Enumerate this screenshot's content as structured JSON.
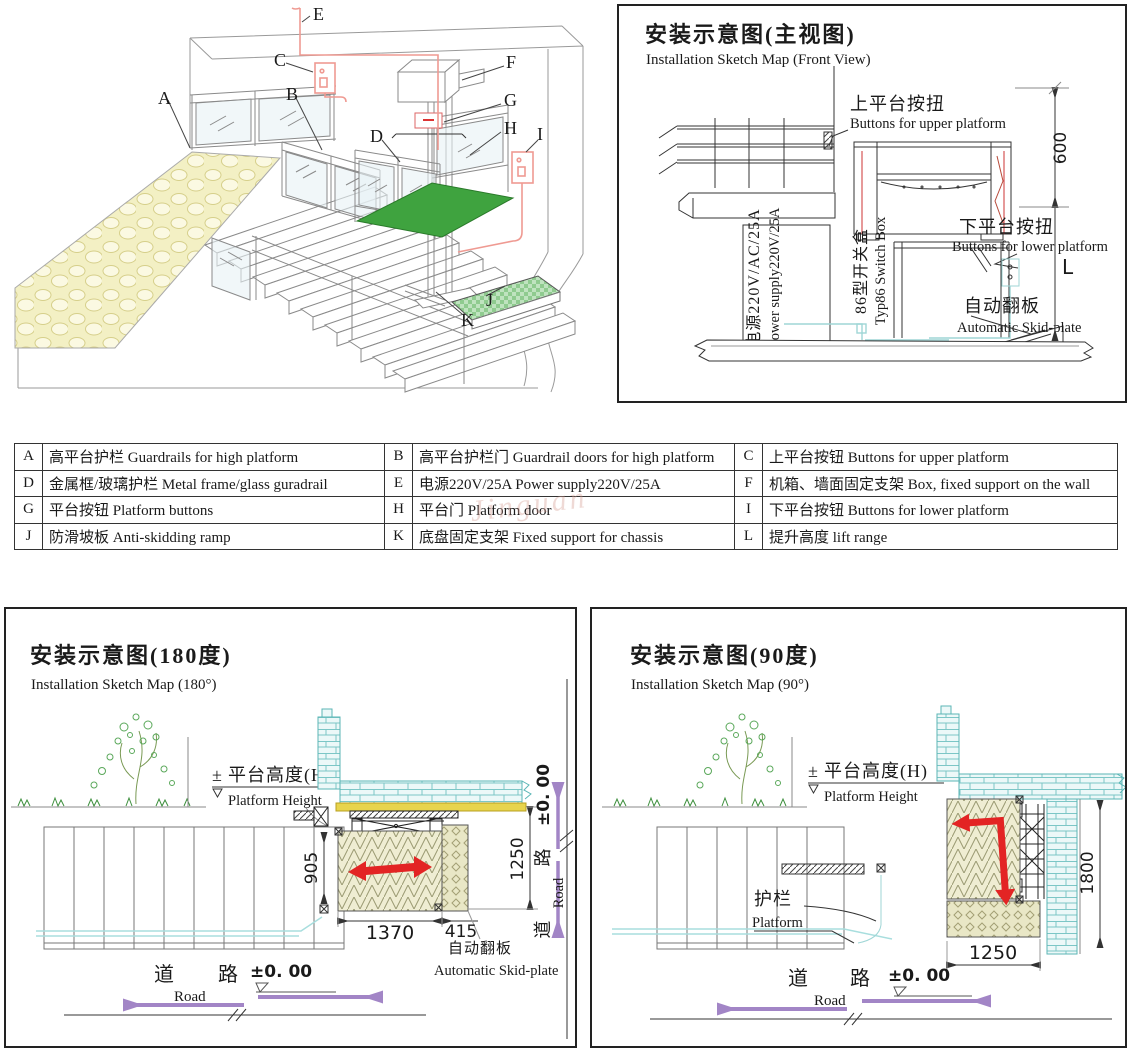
{
  "iso": {
    "callouts": {
      "a": "A",
      "b": "B",
      "c": "C",
      "d": "D",
      "e": "E",
      "f": "F",
      "g": "G",
      "h": "H",
      "i": "I",
      "j": "J",
      "k": "K"
    }
  },
  "front": {
    "title_cn": "安装示意图(主视图)",
    "title_en": "Installation Sketch Map (Front View)",
    "upper_cn": "上平台按扭",
    "upper_en": "Buttons for upper platform",
    "lower_cn": "下平台按扭",
    "lower_en": "Buttons for lower platform",
    "skid_cn": "自动翻板",
    "skid_en": "Automatic Skid-plate",
    "power_cn": "电源220V/AC/25A",
    "power_en": "Power supply220V/25A",
    "switch_cn": "86型开关盒",
    "switch_en": "Typ86 Switch Box",
    "dim_600": "600",
    "dim_l": "L"
  },
  "table": {
    "entries": [
      {
        "key": "A",
        "desc": "高平台护栏 Guardrails for high platform"
      },
      {
        "key": "B",
        "desc": "高平台护栏门 Guardrail doors for high platform"
      },
      {
        "key": "C",
        "desc": "上平台按钮 Buttons for upper platform"
      },
      {
        "key": "D",
        "desc": "金属框/玻璃护栏 Metal frame/glass guradrail"
      },
      {
        "key": "E",
        "desc": "电源220V/25A Power supply220V/25A"
      },
      {
        "key": "F",
        "desc": "机箱、墙面固定支架 Box, fixed support on the wall"
      },
      {
        "key": "G",
        "desc": "平台按钮 Platform buttons"
      },
      {
        "key": "H",
        "desc": "平台门 Platform door"
      },
      {
        "key": "I",
        "desc": "下平台按钮 Buttons for lower platform"
      },
      {
        "key": "J",
        "desc": "防滑坡板 Anti-skidding ramp"
      },
      {
        "key": "K",
        "desc": "底盘固定支架 Fixed support for chassis"
      },
      {
        "key": "L",
        "desc": "提升高度  lift range"
      }
    ]
  },
  "p180": {
    "title_cn": "安装示意图(180度)",
    "title_en": "Installation Sketch Map (180°)",
    "pm": "±",
    "height_cn": "平台高度(H)",
    "height_en": "Platform Height",
    "dim_905": "905",
    "dim_1250": "1250",
    "dim_1370": "1370",
    "dim_415": "415",
    "skid_cn": "自动翻板",
    "skid_en": "Automatic Skid-plate",
    "road_cn_1": "道",
    "road_cn_2": "路",
    "road_en": "Road",
    "level": "±0. 00",
    "side_road_cn_1": "道",
    "side_road_cn_2": "路",
    "side_road_en": "Road",
    "side_level": "±0. 00"
  },
  "p90": {
    "title_cn": "安装示意图(90度)",
    "title_en": "Installation Sketch Map (90°)",
    "pm": "±",
    "height_cn": "平台高度(H)",
    "height_en": "Platform Height",
    "guard_cn": "护栏",
    "guard_en": "Platform",
    "dim_1250": "1250",
    "dim_1800": "1800",
    "road_cn_1": "道",
    "road_cn_2": "路",
    "road_en": "Road",
    "level": "±0. 00"
  },
  "watermark": {
    "text": "Jinguan"
  },
  "colors": {
    "pink_wire": "#ef9a92",
    "cyan_wire": "#9fd6d6",
    "brick": "#7cc6c6",
    "green_floor": "#3fa33f",
    "ramp_green": "#8fcb8f",
    "red_arrow": "#e32424",
    "purple_arrow": "#a285c6"
  }
}
